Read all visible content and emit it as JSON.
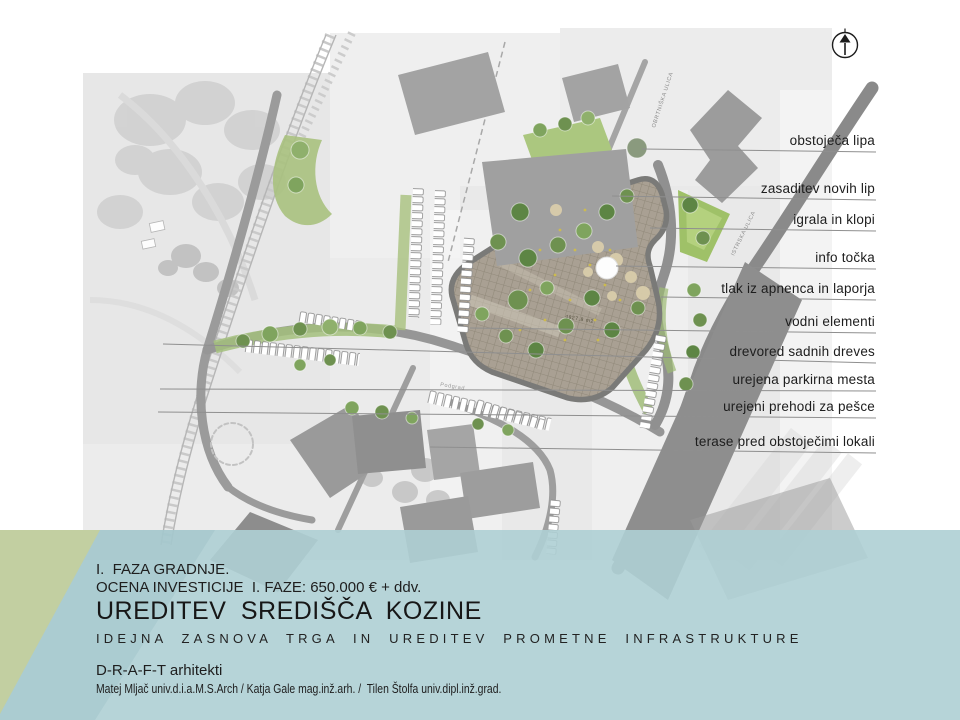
{
  "slide": {
    "phase": "I.  FAZA GRADNJE.",
    "investment": "OCENA INVESTICIJE  I. FAZE: 650.000 € + ddv.",
    "title": "UREDITEV SREDIŠČA KOZINE",
    "subtitle": "IDEJNA ZASNOVA TRGA IN UREDITEV PROMETNE INFRASTRUKTURE",
    "studio": "D-R-A-F-T arhitekti",
    "authors": "Matej Mljač univ.d.i.a.M.S.Arch / Katja Gale mag.inž.arh. /  Tilen Štolfa univ.dipl.inž.grad."
  },
  "legend": {
    "items": [
      {
        "label": "obstoječa lipa"
      },
      {
        "label": "zasaditev novih lip"
      },
      {
        "label": "igrala in klopi"
      },
      {
        "label": "info točka"
      },
      {
        "label": "tlak iz apnenca in laporja"
      },
      {
        "label": "vodni elementi"
      },
      {
        "label": "drevored sadnih dreves"
      },
      {
        "label": "urejena parkirna mesta"
      },
      {
        "label": "urejeni prehodi za pešce"
      },
      {
        "label": "terase pred obstoječimi lokali"
      }
    ]
  },
  "map": {
    "street_labels": {
      "obrtniska": "OBRTNIŠKA ULICA",
      "istrska": "ISTRSKA ULICA",
      "direction": "Podgrad"
    },
    "plaza_area_label": "4827,8 m2"
  },
  "colors": {
    "band_teal": "#b7d4d8",
    "wedge_green": "#c3cf9e",
    "plaza_tan": "#a9a093",
    "road_gray": "#8d8d8d",
    "building_gray": "#a3a3a3",
    "tree_green": "#7ba054"
  }
}
